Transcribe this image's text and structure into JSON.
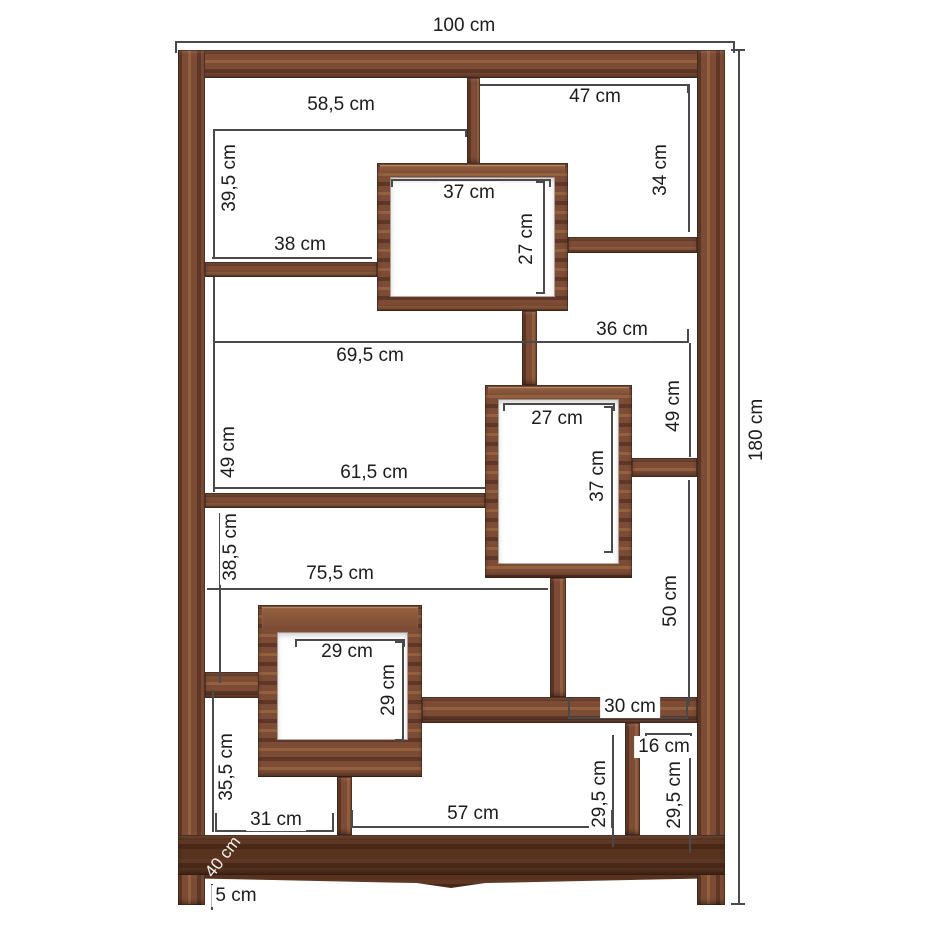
{
  "diagram_type": "furniture-dimension-diagram",
  "unit": "cm",
  "colors": {
    "background": "#ffffff",
    "wood_mid": "#7d4c36",
    "wood_light": "#94613f",
    "wood_dark": "#5f3726",
    "base_dark": "#56321f",
    "dim_line": "#4a4a4a",
    "label_text": "#1c1c1c",
    "label_bg": "#ffffff",
    "depth_label_text": "#f5efe8"
  },
  "dims": {
    "d100": "100 cm",
    "d180": "180 cm",
    "d40": "40 cm",
    "d5": "5 cm",
    "d58_5": "58,5 cm",
    "d47": "47 cm",
    "d39_5": "39,5 cm",
    "d34": "34 cm",
    "d37_box1": "37 cm",
    "d27_box1": "27 cm",
    "d38": "38 cm",
    "d36": "36 cm",
    "d69_5": "69,5 cm",
    "d49_left": "49 cm",
    "d49_right": "49 cm",
    "d27_box2": "27 cm",
    "d37_box2": "37 cm",
    "d61_5": "61,5 cm",
    "d38_5": "38,5 cm",
    "d75_5": "75,5 cm",
    "d50": "50 cm",
    "d29_box3_w": "29 cm",
    "d29_box3_h": "29 cm",
    "d30": "30 cm",
    "d16": "16 cm",
    "d35_5": "35,5 cm",
    "d29_5_left": "29,5 cm",
    "d29_5_right": "29,5 cm",
    "d31": "31 cm",
    "d57": "57 cm"
  }
}
